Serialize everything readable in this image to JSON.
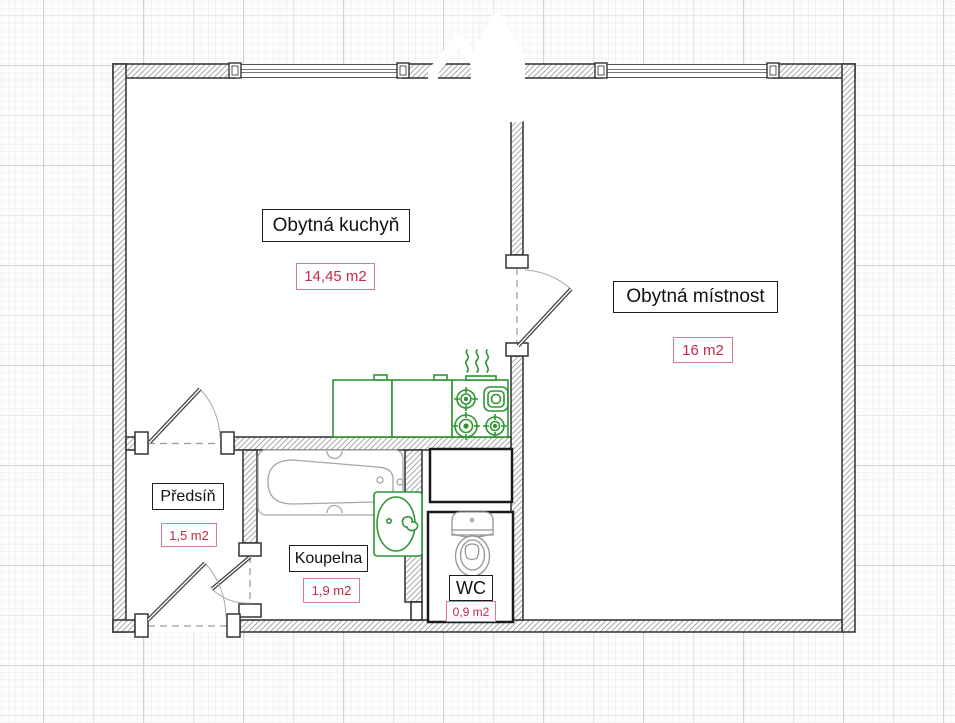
{
  "plan": {
    "type": "apartment-floor-plan",
    "rooms": [
      {
        "id": "kitchen",
        "name": "Obytná kuchyň",
        "area": "14,45 m2"
      },
      {
        "id": "living-room",
        "name": "Obytná místnost",
        "area": "16 m2"
      },
      {
        "id": "hallway",
        "name": "Předsíň",
        "area": "1,5 m2"
      },
      {
        "id": "bathroom",
        "name": "Koupelna",
        "area": "1,9 m2"
      },
      {
        "id": "wc",
        "name": "WC",
        "area": "0,9 m2"
      }
    ],
    "fixtures": [
      "kitchen-counter",
      "stove",
      "heat-marks",
      "bathtub",
      "washbasin",
      "toilet",
      "ventilation-shaft"
    ],
    "openings": [
      "window-kitchen",
      "window-living-room",
      "door-living-room",
      "door-kitchen",
      "door-bathroom",
      "door-entrance"
    ],
    "watermark": "house-logo",
    "colors": {
      "fixture_green": "#2f9532",
      "area_text": "#c22b45",
      "area_border": "#d9778c",
      "wall_outline": "#3b3b3b",
      "sanitary_gray": "#9a9a9a"
    }
  }
}
